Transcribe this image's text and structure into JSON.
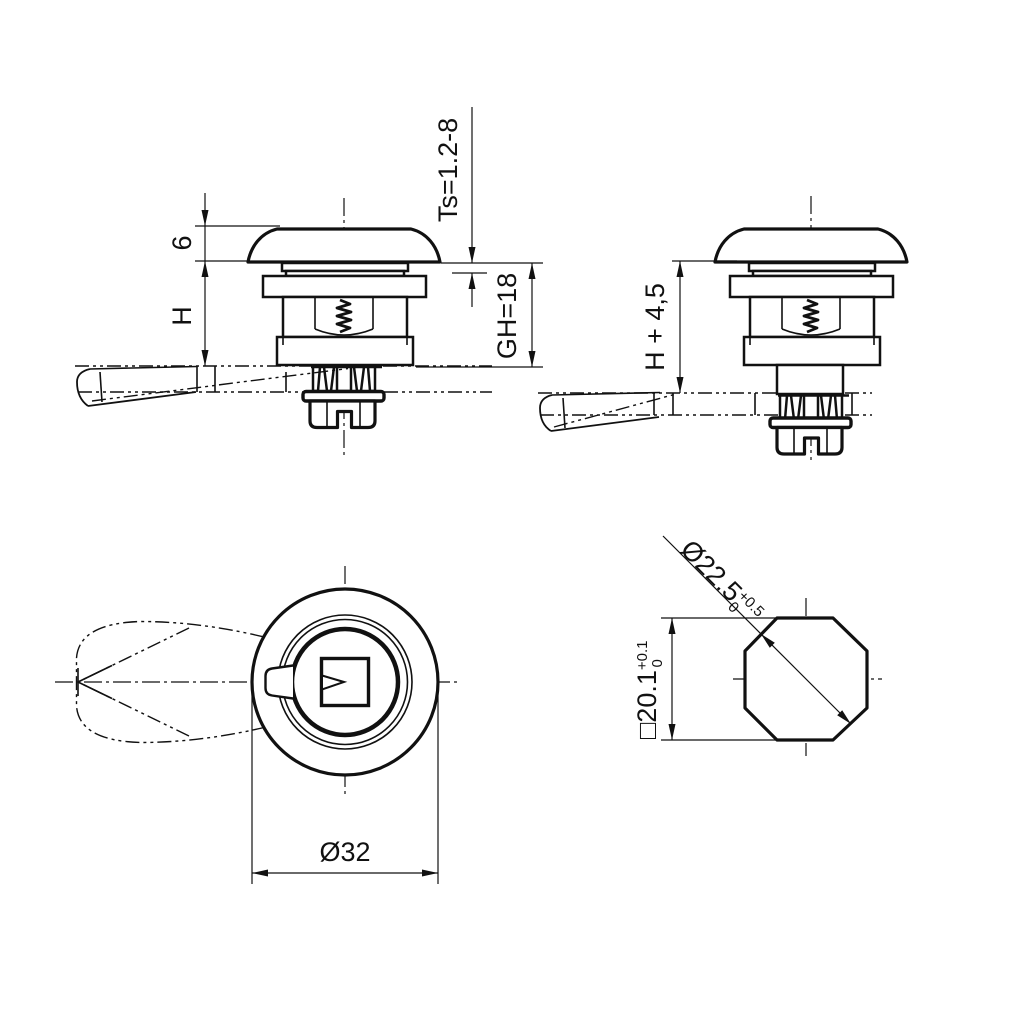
{
  "drawing": {
    "background": "#ffffff",
    "line_color": "#111111",
    "views": {
      "side_closed": {
        "dims": {
          "cap_height": "6",
          "height": "H",
          "panel_thickness": "Ts=1.2-8",
          "grip_height": "GH=18"
        }
      },
      "side_open": {
        "dims": {
          "height_plus": "H + 4,5"
        }
      },
      "plan": {
        "dims": {
          "outer_diameter": "Ø32"
        }
      },
      "cutout": {
        "dims": {
          "diagonal": "Ø22.5",
          "diagonal_tol_upper": "+0.5",
          "diagonal_tol_lower": "0",
          "square": "□20.1",
          "square_tol_upper": "+0.1",
          "square_tol_lower": "0"
        }
      }
    }
  }
}
